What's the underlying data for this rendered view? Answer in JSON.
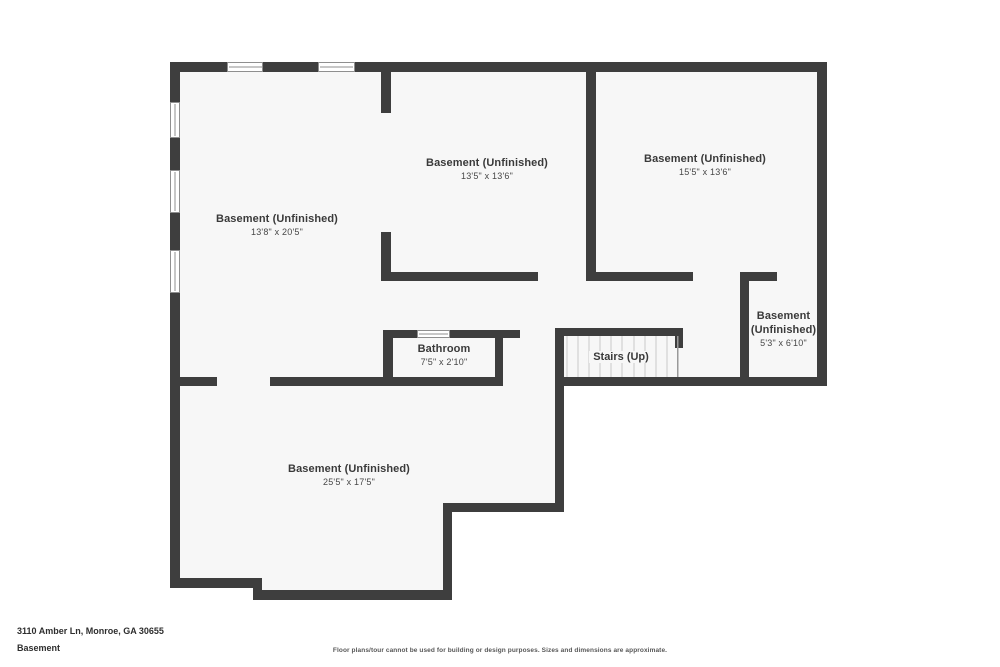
{
  "colors": {
    "wall": "#3e3e3e",
    "floor": "#f7f7f7",
    "background": "#ffffff",
    "window_frame": "#8f8f8f",
    "stair_tread": "#c9c9c9",
    "stair_edge": "#999999",
    "label_text": "#3a3a3a"
  },
  "floorplan": {
    "rooms": [
      {
        "name": "Basement (Unfinished)",
        "dims": "13'8\" x 20'5\""
      },
      {
        "name": "Basement (Unfinished)",
        "dims": "13'5\" x 13'6\""
      },
      {
        "name": "Basement (Unfinished)",
        "dims": "15'5\" x 13'6\""
      },
      {
        "name": "Basement (Unfinished)",
        "dims": "5'3\" x 6'10\""
      },
      {
        "name": "Bathroom",
        "dims": "7'5\" x 2'10\""
      },
      {
        "name": "Basement (Unfinished)",
        "dims": "25'5\" x 17'5\""
      }
    ],
    "stairs": {
      "label": "Stairs (Up)"
    }
  },
  "footer": {
    "address": "3110 Amber Ln, Monroe, GA 30655",
    "floor_label": "Basement",
    "disclaimer": "Floor plans/tour cannot be used for building or design purposes. Sizes and dimensions are approximate."
  }
}
